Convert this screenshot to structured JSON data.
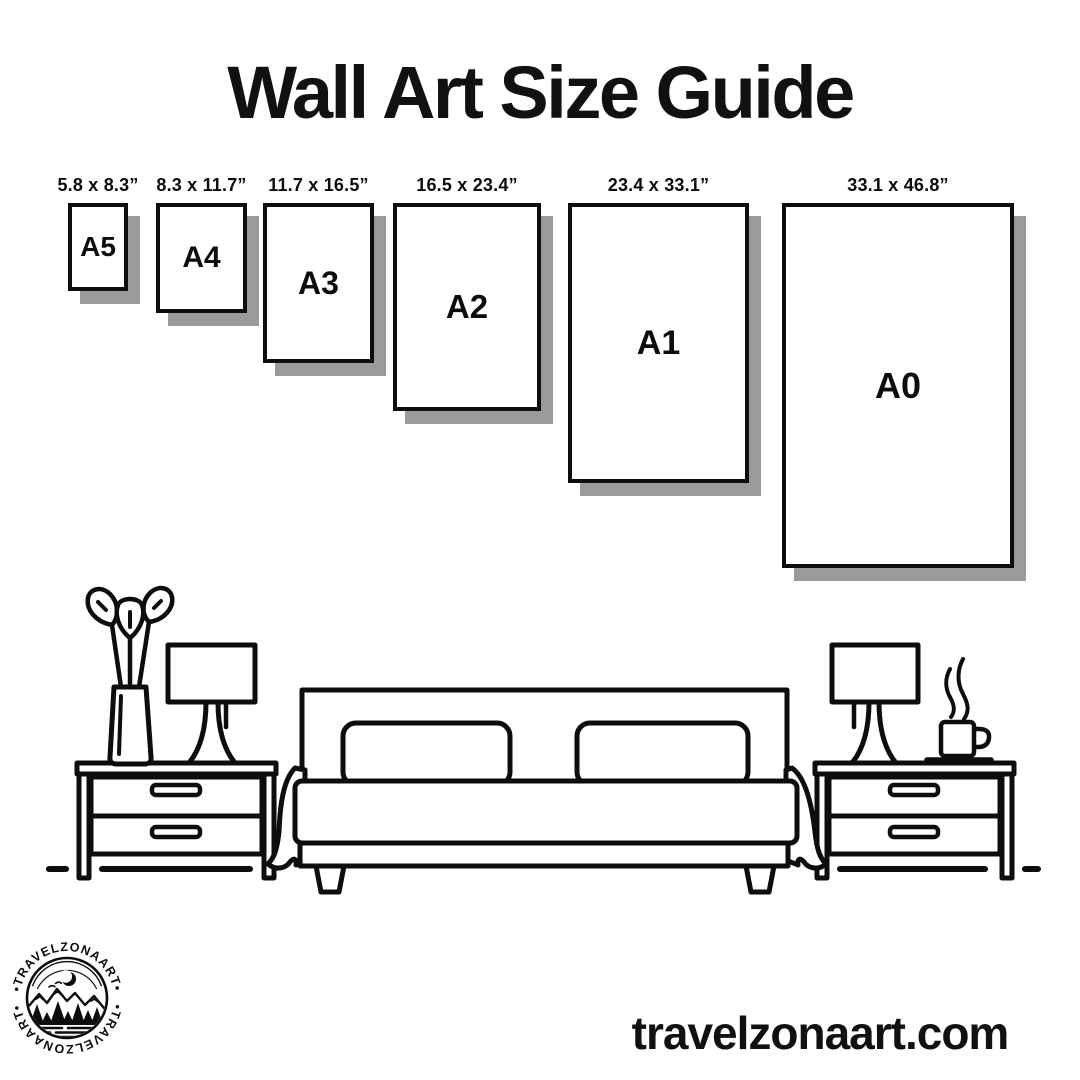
{
  "title": "Wall Art Size Guide",
  "size_guide": {
    "items": [
      {
        "label": "A5",
        "dimensions": "5.8 x 8.3”"
      },
      {
        "label": "A4",
        "dimensions": "8.3 x 11.7”"
      },
      {
        "label": "A3",
        "dimensions": "11.7 x 16.5”"
      },
      {
        "label": "A2",
        "dimensions": "16.5 x 23.4”"
      },
      {
        "label": "A1",
        "dimensions": "23.4 x 33.1”"
      },
      {
        "label": "A0",
        "dimensions": "33.1 x 46.8”"
      }
    ]
  },
  "brand": {
    "logo_text_top": "•TRAVELZONAART•",
    "logo_text_bottom": "•TRAVELZONAART•",
    "website": "travelzonaart.com"
  },
  "colors": {
    "ink": "#0d0d0d",
    "shadow": "#9a9a9a",
    "background": "#ffffff"
  }
}
